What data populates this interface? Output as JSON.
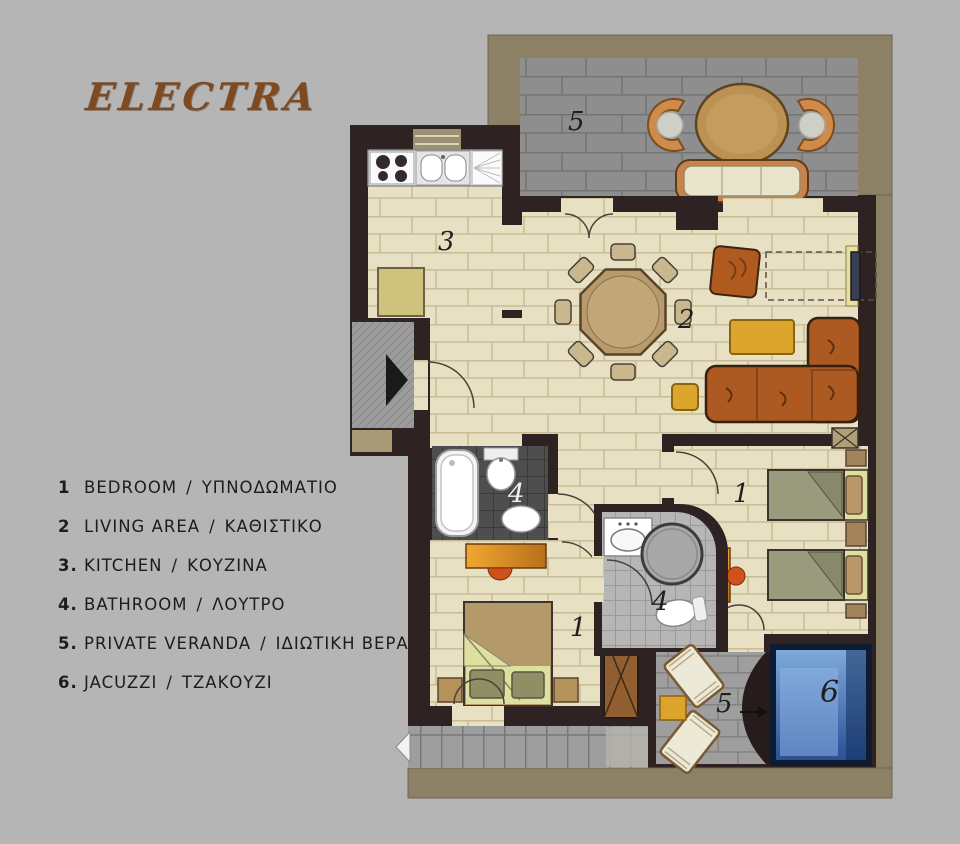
{
  "title": "ELECTRA",
  "legend": {
    "items": [
      {
        "num": "1",
        "en": "BEDROOM",
        "sep": "/",
        "gr": "ΥΠΝΟΔΩΜΑΤΙΟ"
      },
      {
        "num": "2",
        "en": "LIVING AREA",
        "sep": "/",
        "gr": "ΚΑΘΙΣΤΙΚΟ"
      },
      {
        "num": "3.",
        "en": "KITCHEN",
        "sep": "/",
        "gr": "ΚΟΥΖΙΝΑ"
      },
      {
        "num": "4.",
        "en": "BATHROOM",
        "sep": "/",
        "gr": "ΛΟΥΤΡΟ"
      },
      {
        "num": "5.",
        "en": "PRIVATE VERANDA",
        "sep": "/",
        "gr": "ΙΔΙΩΤΙΚΗ ΒΕΡΑΝΤΑ"
      },
      {
        "num": "6.",
        "en": "JACUZZI",
        "sep": "/",
        "gr": "ΤΖΑΚΟΥΖΙ"
      }
    ]
  },
  "plan": {
    "labels": {
      "veranda_top": "5",
      "kitchen": "3",
      "living": "2",
      "bath_main": "4",
      "bath_ensuite": "4",
      "bedroom_double": "1",
      "bedroom_twin": "1",
      "veranda_lounge": "5",
      "jacuzzi": "6"
    }
  },
  "colors": {
    "background": "#b5b5b5",
    "title_brown": "#7d4a22",
    "wall_dark": "#2e2222",
    "floor_cream": "#e8e0c3",
    "veranda_gray": "#8e8e8e",
    "frame_tan": "#8c8065",
    "furniture_rust": "#ad5a22",
    "furniture_yellow": "#dca62e",
    "jacuzzi_blue": "#2a5096",
    "bath_dark_tile": "#4e4e4e"
  }
}
